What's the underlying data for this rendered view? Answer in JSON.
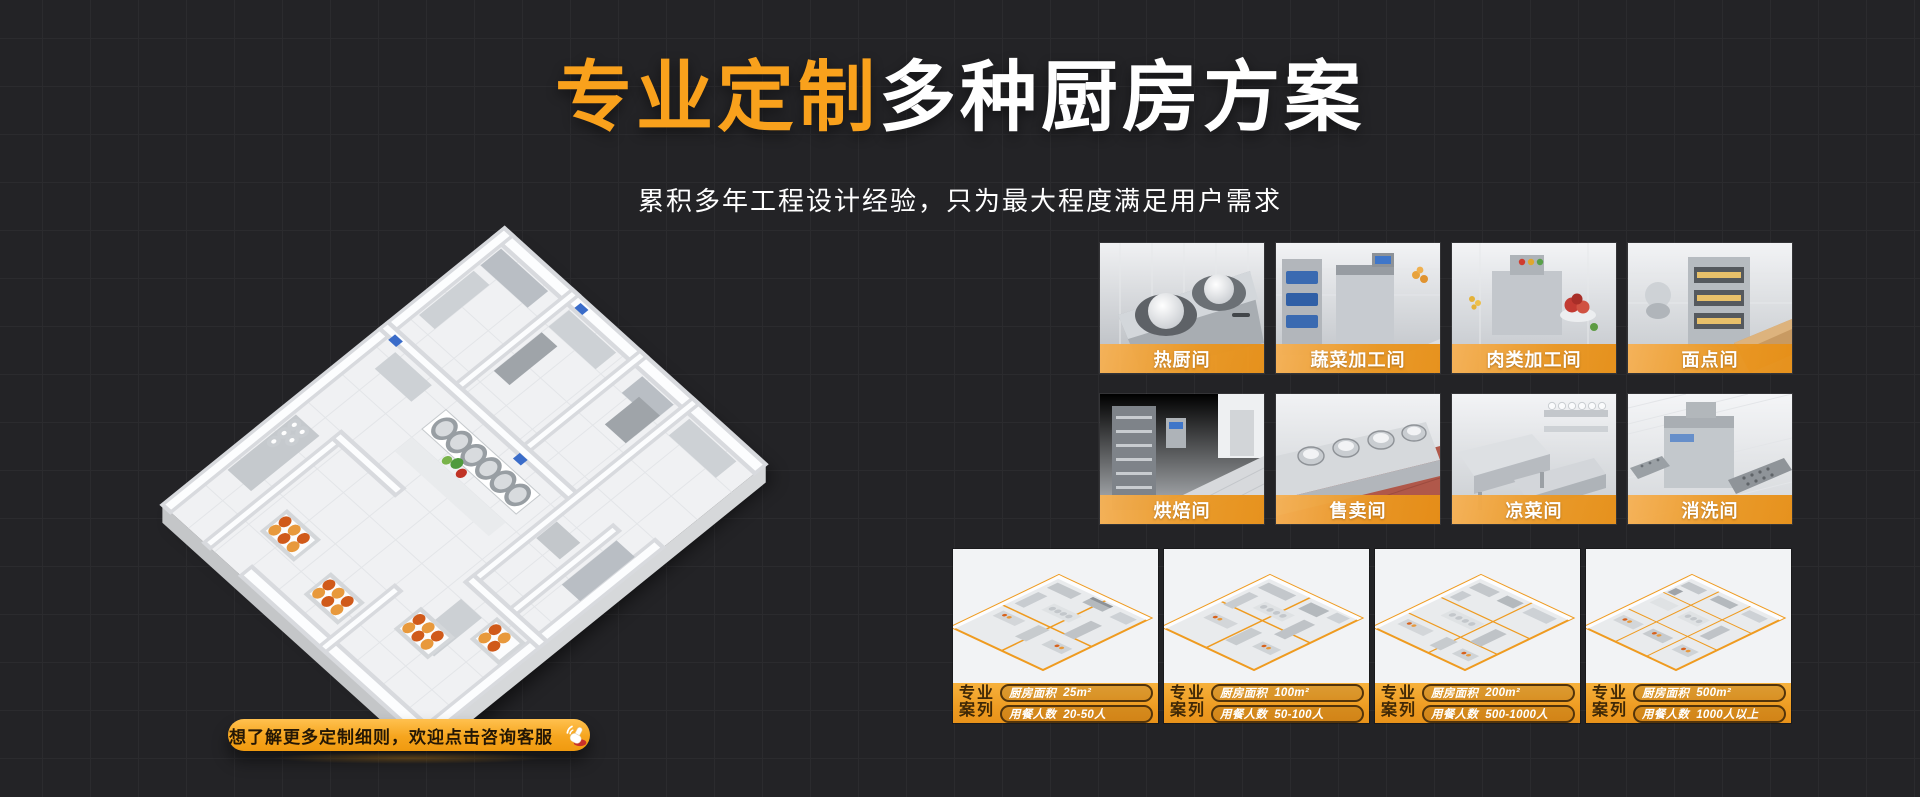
{
  "colors": {
    "background": "#232326",
    "accent_orange": "#F5A01D",
    "title_orange": "#F9A11C",
    "label_bar_orange": "#EA9722"
  },
  "hero": {
    "title_highlight": "专业定制",
    "title_rest": "多种厨房方案",
    "subtitle": "累积多年工程设计经验，只为最大程度满足用户需求"
  },
  "cta": {
    "label": "想了解更多定制细则，欢迎点击咨询客服",
    "icon": "click-hand-icon"
  },
  "gallery": {
    "tiles": [
      {
        "label": "热厨间"
      },
      {
        "label": "蔬菜加工间"
      },
      {
        "label": "肉类加工间"
      },
      {
        "label": "面点间"
      },
      {
        "label": "烘焙间"
      },
      {
        "label": "售卖间"
      },
      {
        "label": "凉菜间"
      },
      {
        "label": "消洗间"
      }
    ]
  },
  "cases": {
    "badge_line1": "专业",
    "badge_line2": "案列",
    "area_label": "厨房面积",
    "diners_label": "用餐人数",
    "items": [
      {
        "area": "25m²",
        "diners": "20-50人"
      },
      {
        "area": "100m²",
        "diners": "50-100人"
      },
      {
        "area": "200m²",
        "diners": "500-1000人"
      },
      {
        "area": "500m²",
        "diners": "1000人以上"
      }
    ]
  }
}
